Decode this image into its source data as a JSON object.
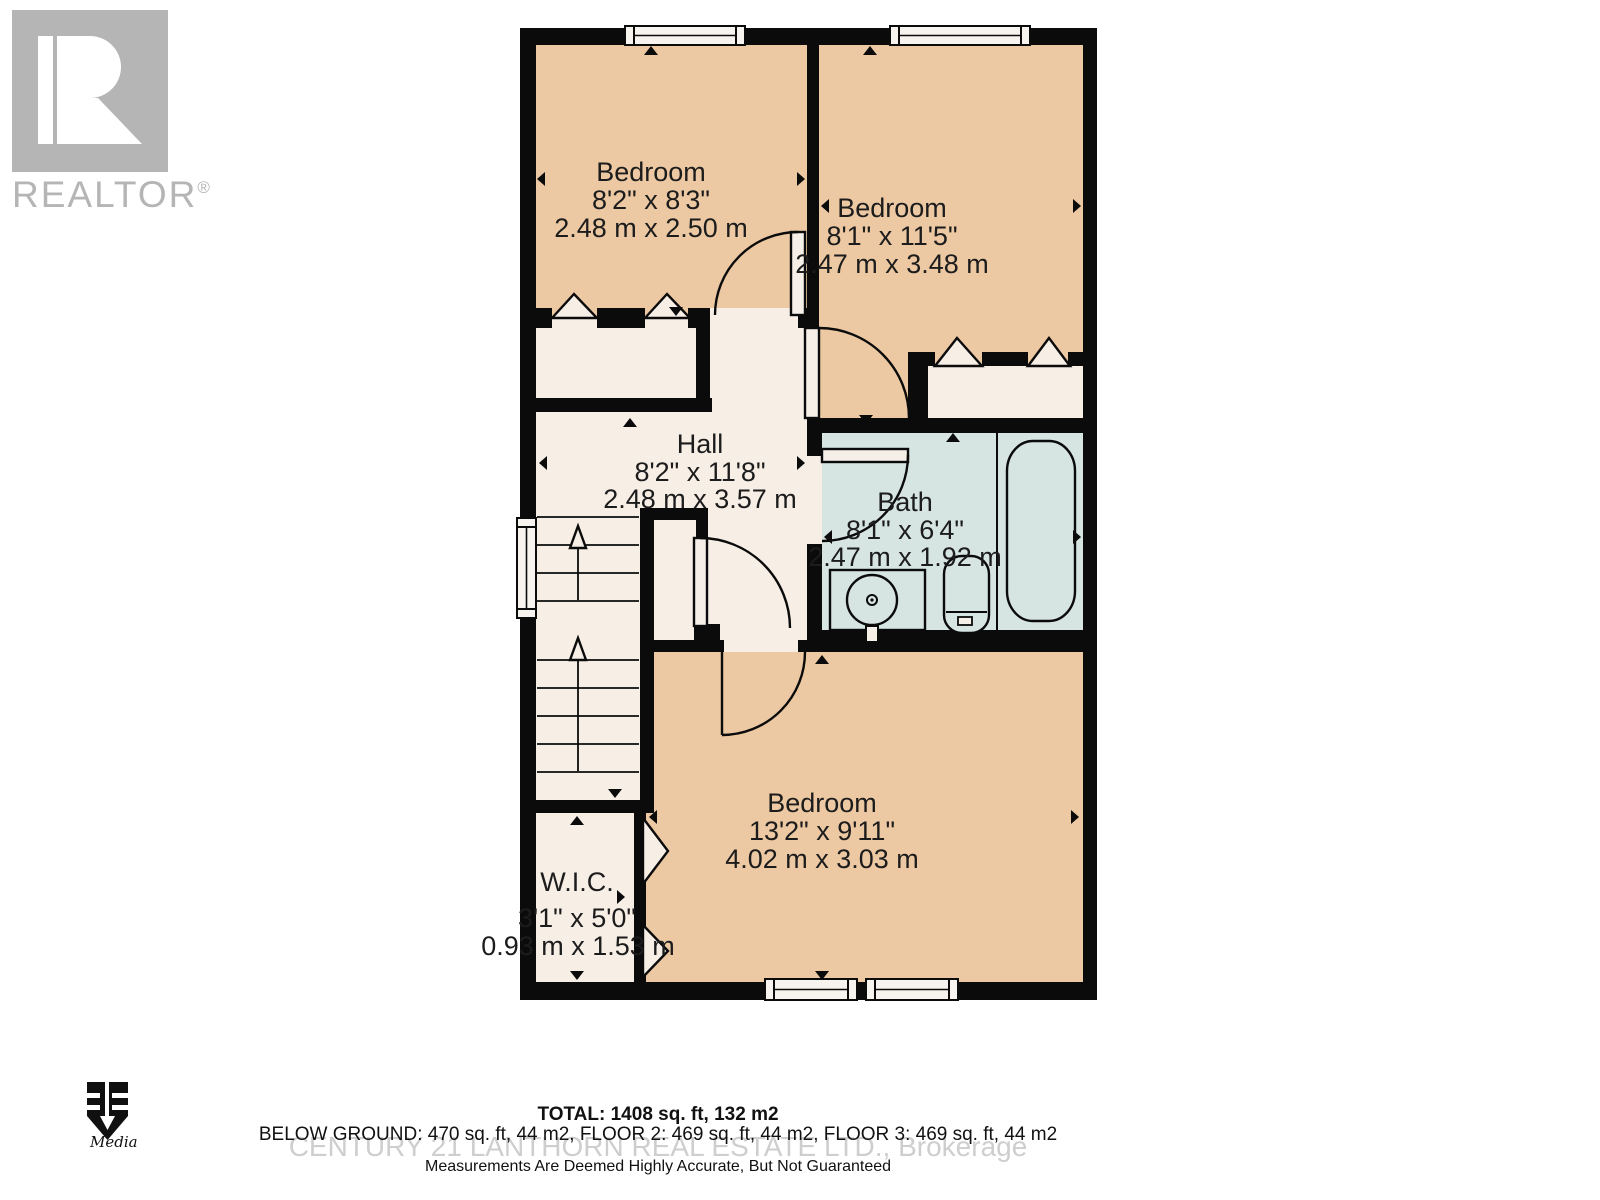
{
  "branding": {
    "realtor_label": "REALTOR",
    "realtor_reg": "®",
    "media_sub": "Media"
  },
  "plan": {
    "rooms": [
      {
        "name": "Bedroom",
        "dim_ft": "8'2\" x 8'3\"",
        "dim_m": "2.48 m x 2.50 m"
      },
      {
        "name": "Bedroom",
        "dim_ft": "8'1\" x 11'5\"",
        "dim_m": "2.47 m x 3.48 m"
      },
      {
        "name": "Hall",
        "dim_ft": "8'2\" x 11'8\"",
        "dim_m": "2.48 m x 3.57 m"
      },
      {
        "name": "Bath",
        "dim_ft": "8'1\" x 6'4\"",
        "dim_m": "2.47 m x 1.92 m"
      },
      {
        "name": "Bedroom",
        "dim_ft": "13'2\" x 9'11\"",
        "dim_m": "4.02 m x 3.03 m"
      },
      {
        "name": "W.I.C.",
        "dim_ft": "3'1\" x 5'0\"",
        "dim_m": "0.93 m x 1.53 m"
      }
    ]
  },
  "footer": {
    "total": "TOTAL: 1408 sq. ft, 132 m2",
    "floors": "BELOW GROUND: 470 sq. ft, 44 m2, FLOOR 2: 469 sq. ft, 44 m2, FLOOR 3: 469 sq. ft, 44 m2",
    "watermark": "CENTURY 21 LANTHORN REAL ESTATE LTD., Brokerage",
    "disclaimer": "Measurements Are Deemed Highly Accurate, But Not Guaranteed"
  },
  "colors": {
    "wall": "#0b0b0b",
    "bedroom": "#ecc8a3",
    "hall": "#f7eee6",
    "bath": "#d6e4e2",
    "window": "#f7f3ee",
    "label": "#1c1c1c",
    "logo_gray": "#b5b5b5",
    "watermark": "#c6c6c6",
    "footer_text": "#111111"
  }
}
